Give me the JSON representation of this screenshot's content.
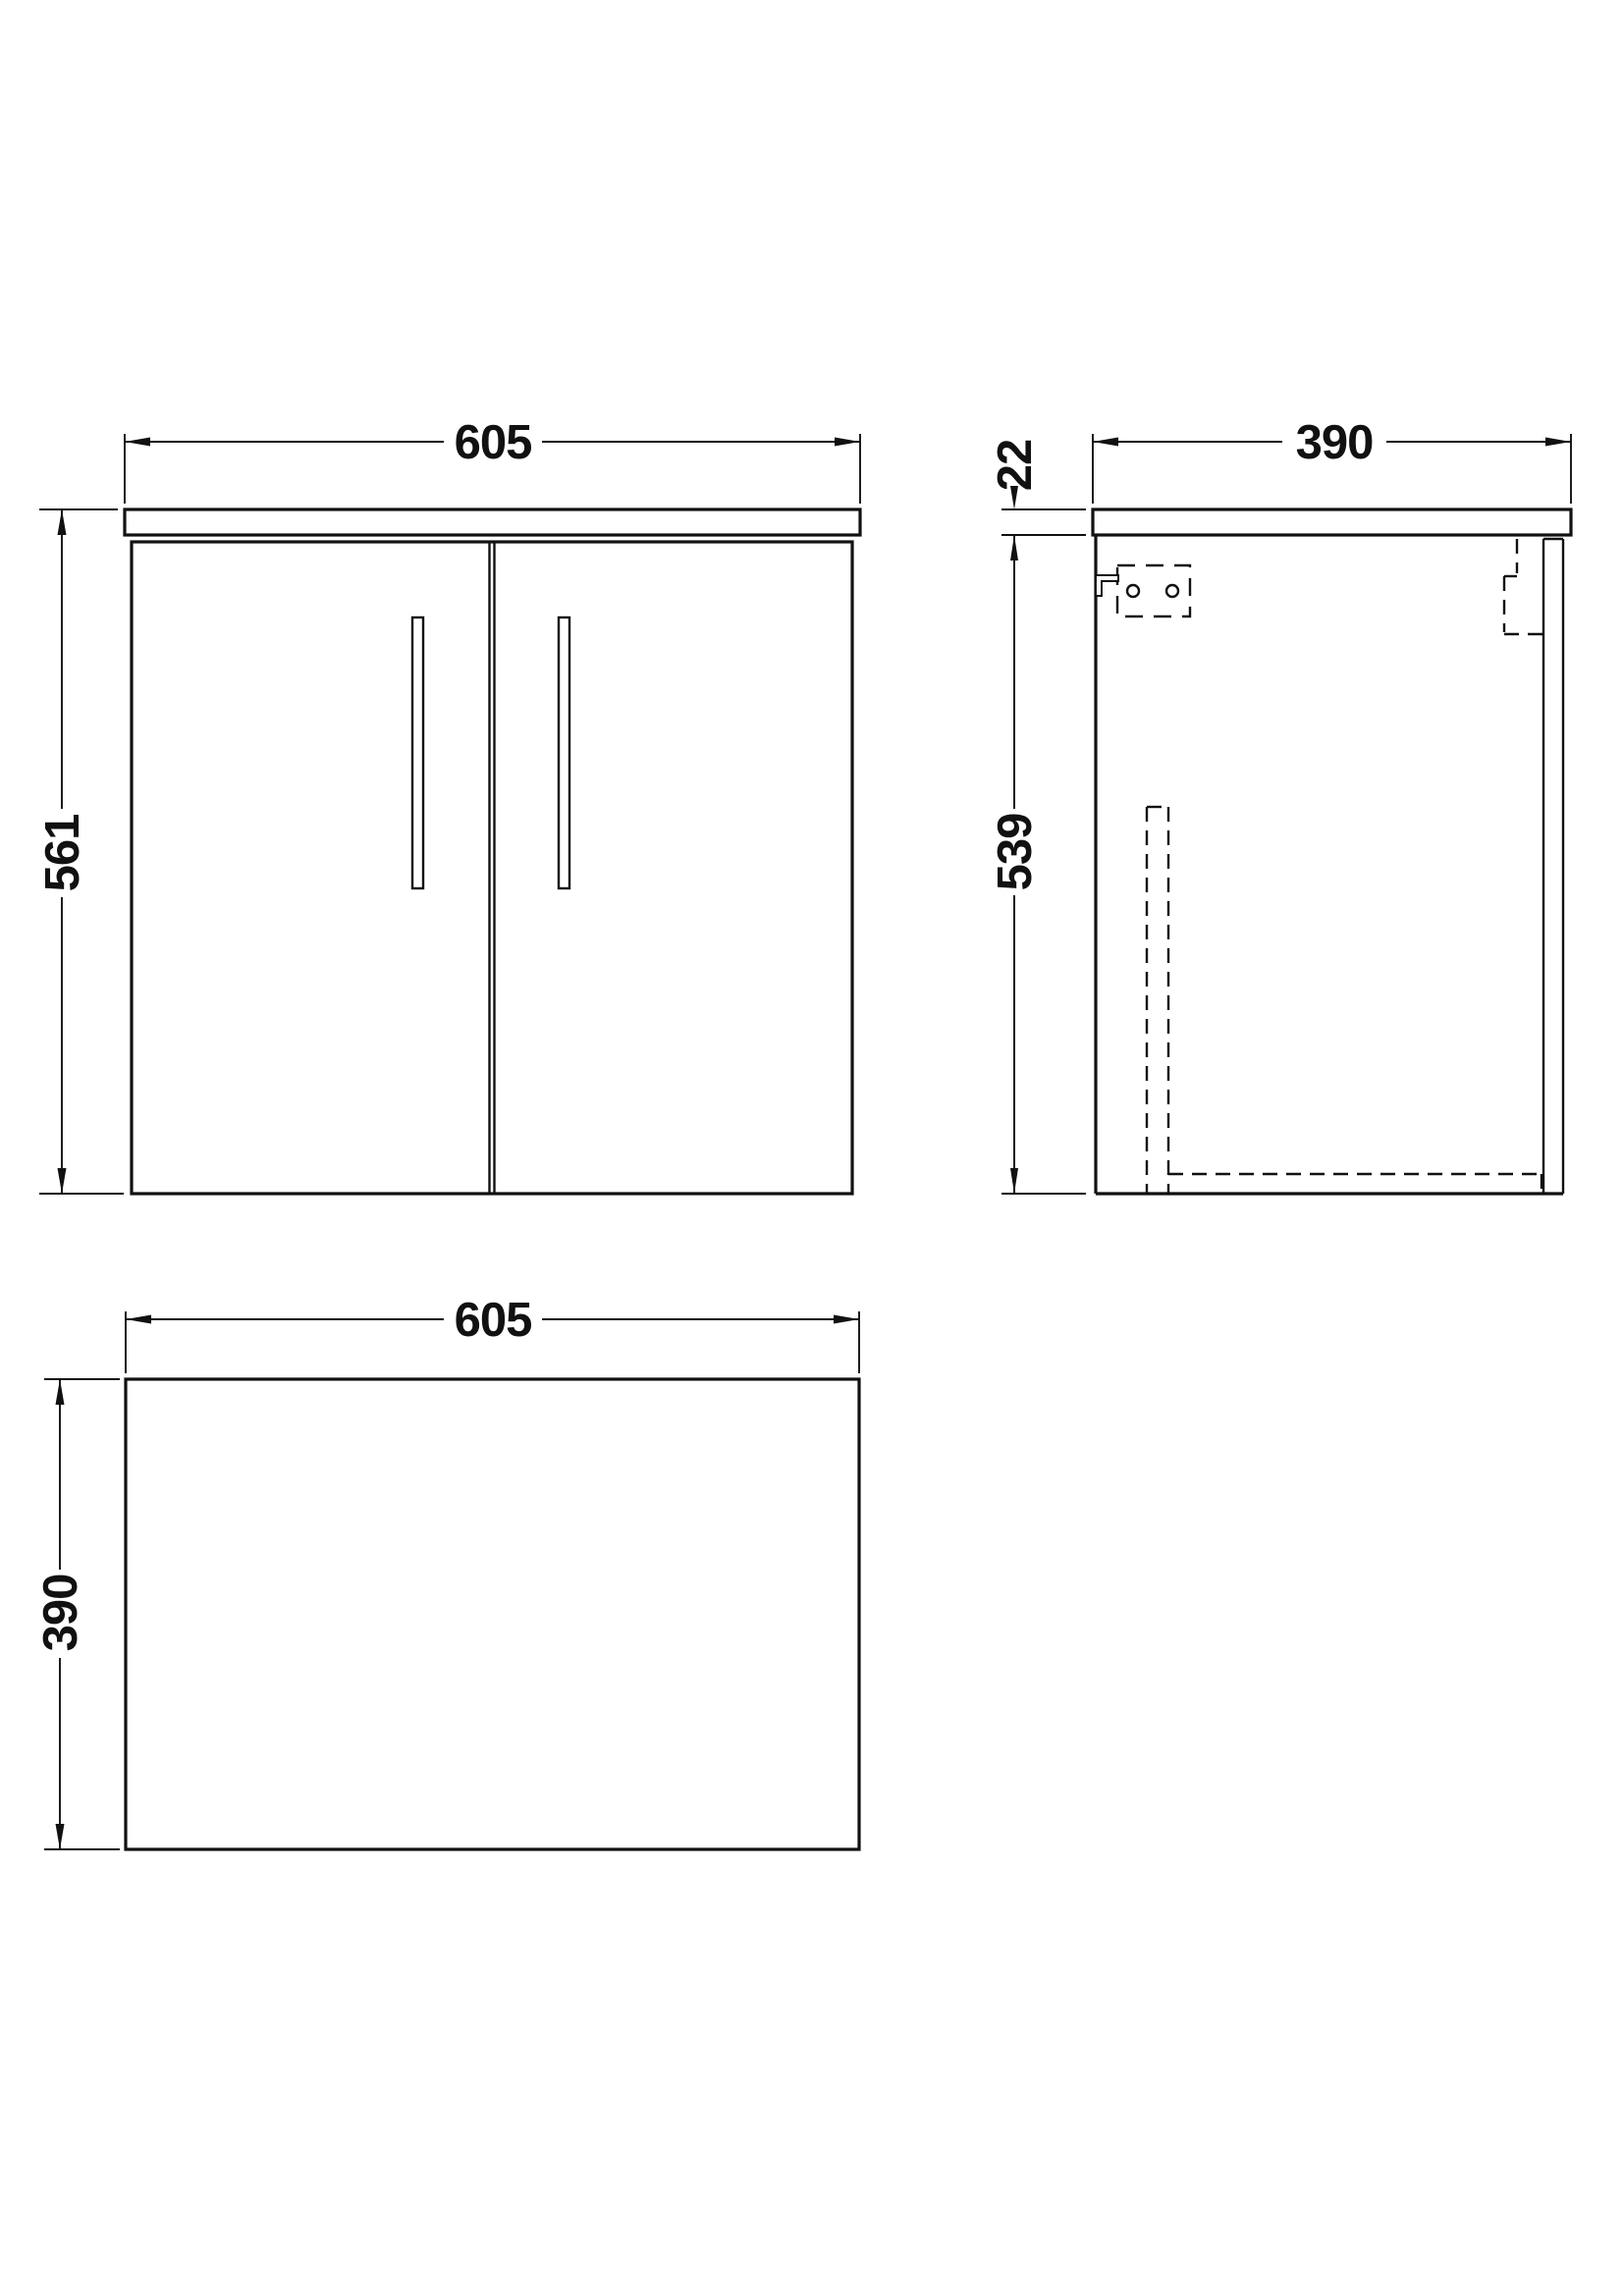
{
  "drawing": {
    "background": "#ffffff",
    "line_color": "#111111",
    "views": {
      "front": {
        "label": "front-elevation",
        "width_label": "605",
        "height_label": "561"
      },
      "side": {
        "label": "side-elevation",
        "depth_label": "390",
        "counter_thickness_label": "22",
        "body_height_label": "539"
      },
      "plan": {
        "label": "plan-view",
        "width_label": "605",
        "depth_label": "390"
      }
    }
  }
}
